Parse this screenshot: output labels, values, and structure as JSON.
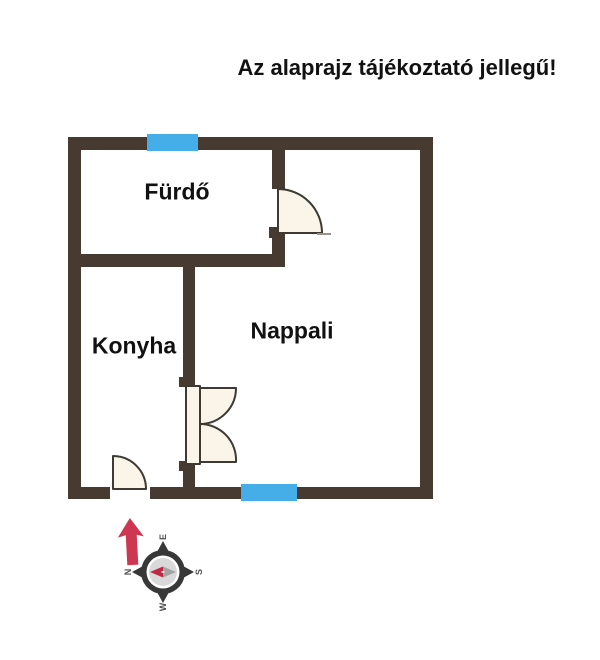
{
  "title": "Az alaprajz tájékoztató jellegű!",
  "rooms": {
    "bathroom": "Fürdő",
    "kitchen": "Konyha",
    "living_room": "Nappali"
  },
  "compass": {
    "n": "N",
    "e": "E",
    "s": "S",
    "w": "W"
  },
  "colors": {
    "wall": "#473b31",
    "window": "#45aee9",
    "door-fill": "#faf5e8",
    "door-stroke": "#3e3933",
    "arrow": "#cd3752",
    "needle-red": "#c22742",
    "needle-gray": "#a3a3a3",
    "ring": "#383838",
    "inner-disc": "#d9d9d9",
    "text": "#111111"
  }
}
